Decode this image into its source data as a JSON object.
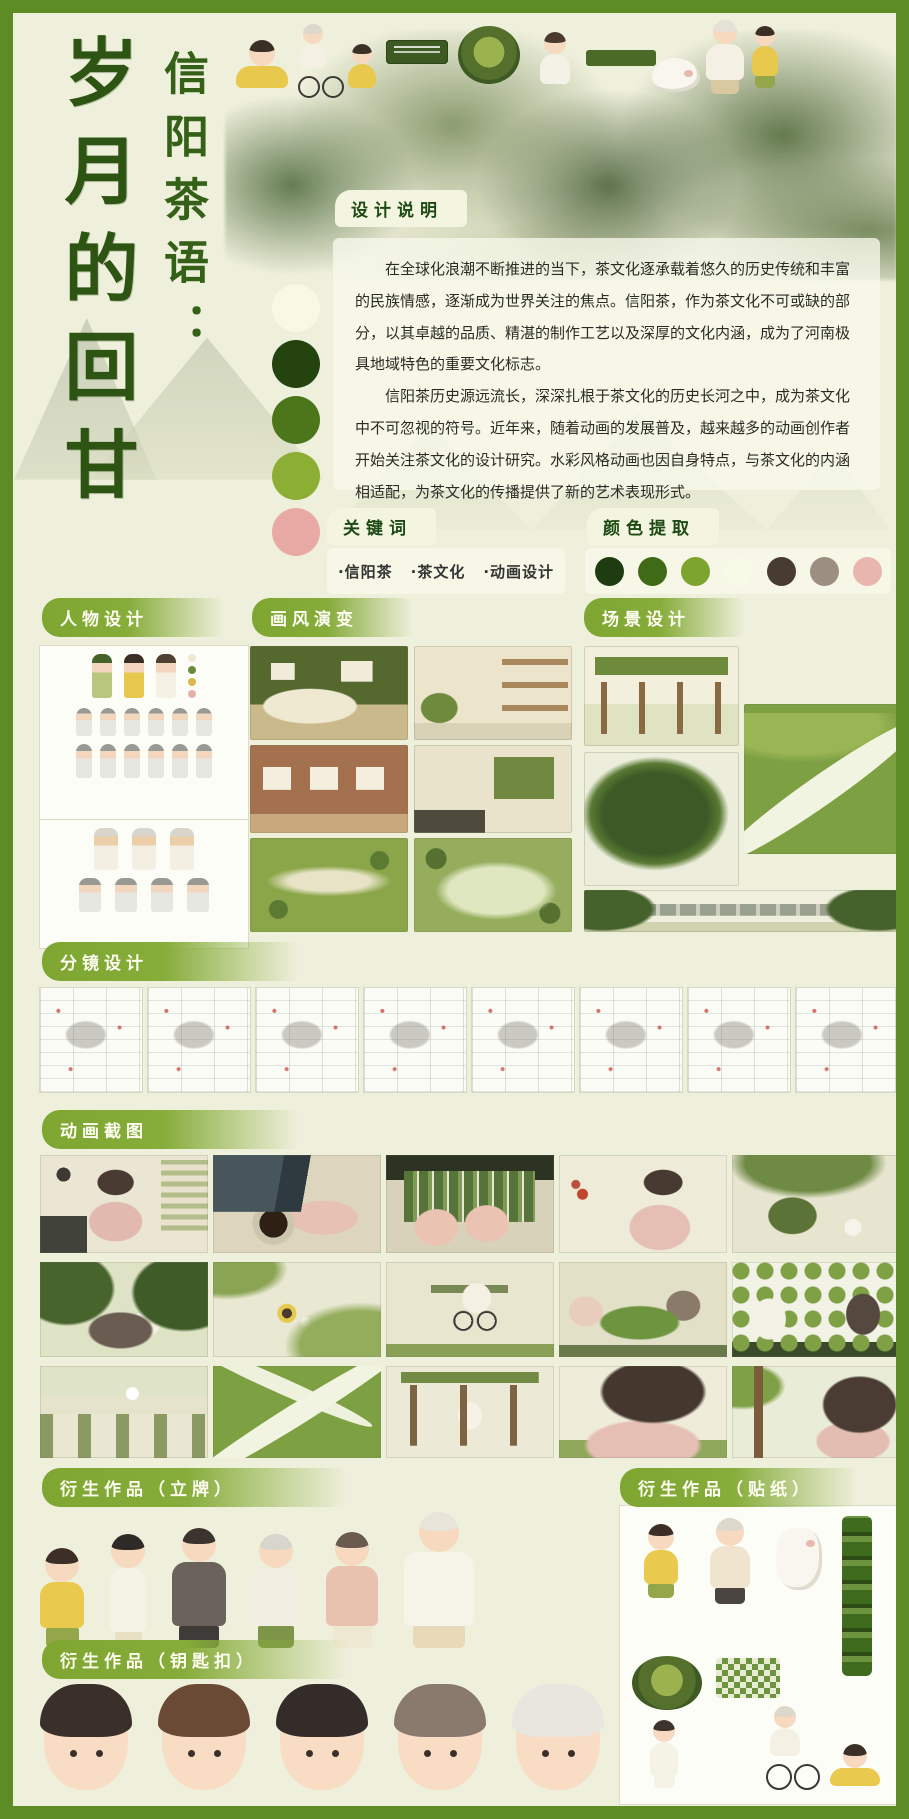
{
  "poster": {
    "title_main": "岁月的回甘",
    "title_prefix": "信阳茶语："
  },
  "design_note": {
    "heading": "设计说明",
    "paragraphs": [
      "在全球化浪潮不断推进的当下，茶文化逐承载着悠久的历史传统和丰富的民族情感，逐渐成为世界关注的焦点。信阳茶，作为茶文化不可或缺的部分，以其卓越的品质、精湛的制作工艺以及深厚的文化内涵，成为了河南极具地域特色的重要文化标志。",
      "信阳茶历史源远流长，深深扎根于茶文化的历史长河之中，成为茶文化中不可忽视的符号。近年来，随着动画的发展普及，越来越多的动画创作者开始关注茶文化的设计研究。水彩风格动画也因自身特点，与茶文化的内涵相适配，为茶文化的传播提供了新的艺术表现形式。"
    ]
  },
  "keywords": {
    "heading": "关键词",
    "items": [
      "·信阳茶",
      "·茶文化",
      "·动画设计"
    ]
  },
  "palette": {
    "heading": "颜色提取",
    "swatches": [
      "#1e3c10",
      "#3f6b16",
      "#7da42c",
      "#f8fae8",
      "#483b30",
      "#9c8e80",
      "#e9b6af"
    ],
    "side_dots": [
      "#f7f9e5",
      "#24430f",
      "#4b7619",
      "#8cae34",
      "#e9aaa5"
    ]
  },
  "sections": {
    "character": "人物设计",
    "style": "画风演变",
    "scene": "场景设计",
    "storyboard": "分镜设计",
    "stills": "动画截图",
    "standee": "衍生作品（立牌）",
    "sticker": "衍生作品（贴纸）",
    "keychain": "衍生作品（钥匙扣）"
  },
  "colors": {
    "frame": "#5d8b24",
    "background": "#eff0dc"
  }
}
